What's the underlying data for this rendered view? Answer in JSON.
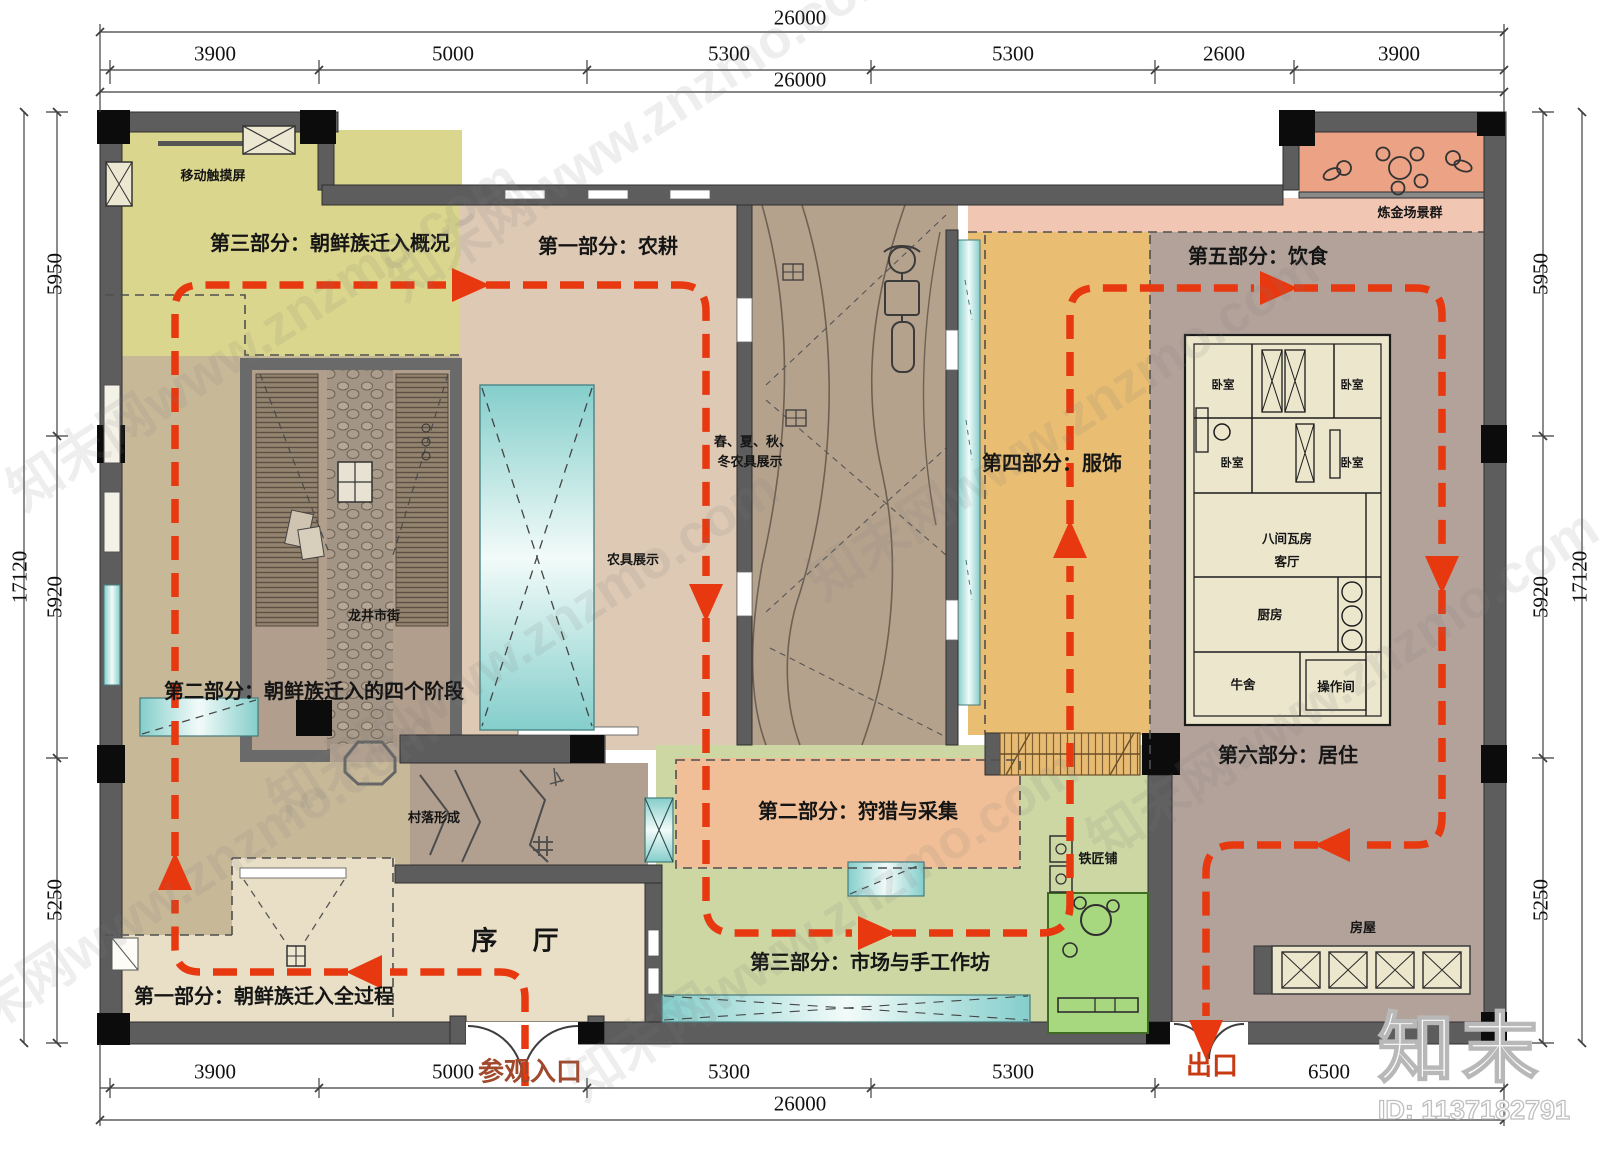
{
  "watermark": {
    "tile": "知末网www.znzmo.com",
    "logo": "知末",
    "id_label": "ID: 1137182791"
  },
  "colors": {
    "route_red": "#e8380f",
    "wall_grey": "#5d5d5d",
    "zone_yellow": "#dbd68d",
    "zone_tan": "#c7b898",
    "zone_farming": "#ddc9b4",
    "zone_clothing": "#e9bd72",
    "zone_dining_living": "#b2a29a",
    "zone_hunting": "#f0bf97",
    "zone_market": "#ccd7a4",
    "zone_smelting": "#eba285",
    "zone_lobby": "#e8dfc6",
    "blacksmith_green": "#a7d77e"
  },
  "dimensions": {
    "top_total": "26000",
    "top_total_inner": "26000",
    "top_segments": [
      "3900",
      "5000",
      "5300",
      "5300",
      "2600",
      "3900"
    ],
    "bottom_segments": [
      "3900",
      "5000",
      "5300",
      "5300",
      "6500"
    ],
    "bottom_total": "26000",
    "side_total": "17120",
    "side_segments": [
      "5950",
      "5920",
      "5250"
    ]
  },
  "zones": {
    "part3_overview": "第三部分：朝鲜族迁入概况",
    "part1_farming": "第一部分：农耕",
    "part5_food": "第五部分：饮食",
    "part4_clothing": "第四部分：服饰",
    "part2_stages": "第二部分：朝鲜族迁入的四个阶段",
    "part6_living": "第六部分：居住",
    "part2_hunting": "第二部分：狩猎与采集",
    "part3_market": "第三部分：市场与手工作坊",
    "part1_process": "第一部分：朝鲜族迁入全过程",
    "lobby": "序 厅"
  },
  "rooms": {
    "touch_screen": "移动触摸屏",
    "longjing_street": "龙井市街",
    "village_formation": "村落形成",
    "farm_tools": "农具展示",
    "seasonal_line1": "春、夏、秋、",
    "seasonal_line2": "冬农具展示",
    "smelting": "炼金场景群",
    "blacksmith": "铁匠铺",
    "house": "房屋",
    "bedroom": "卧室",
    "eight_room_house": "八间瓦房",
    "living_room": "客厅",
    "kitchen": "厨房",
    "cowshed": "牛舍",
    "workroom": "操作间"
  },
  "route": {
    "entrance_label": "参观入口",
    "exit_label": "出口"
  }
}
